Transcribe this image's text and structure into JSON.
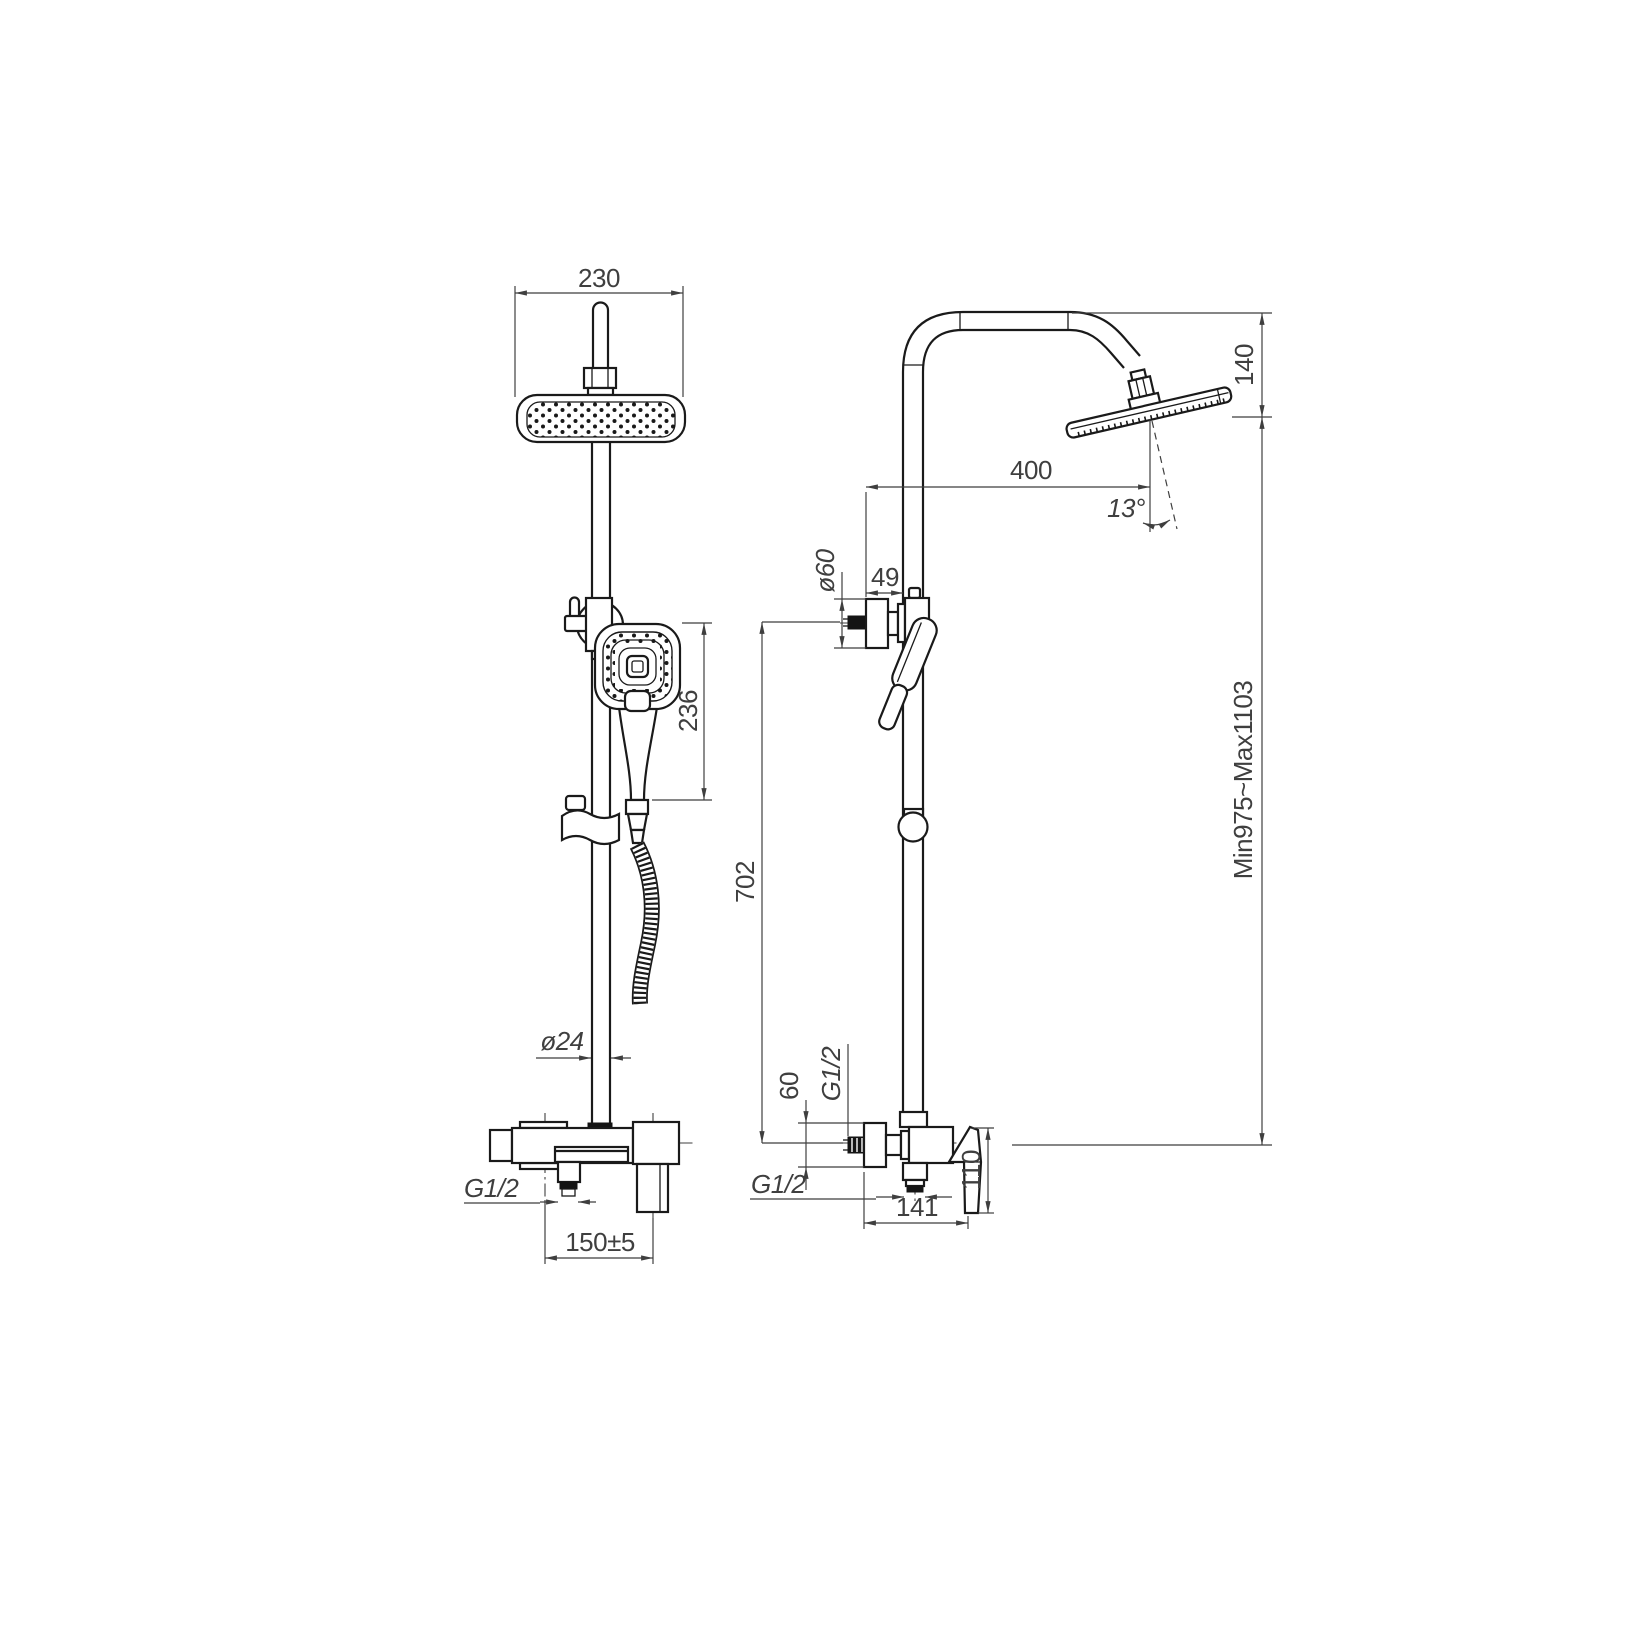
{
  "drawing": {
    "title": "shower-column-technical-drawing",
    "colors": {
      "background": "#ffffff",
      "line": "#1a1a1a",
      "dim": "#3f3f3f"
    },
    "front_view": {
      "head_width": "230",
      "hand_shower_height": "236",
      "pipe_diameter": "ø24",
      "outlet_thread": "G1/2",
      "inlet_spacing": "150±5"
    },
    "side_view": {
      "head_drop": "140",
      "head_reach": "400",
      "head_angle": "13°",
      "holder_diameter": "ø60",
      "holder_offset": "49",
      "bar_to_mixer": "702",
      "height_range": "Min975~Max1103",
      "flange_height": "60",
      "wall_thread": "G1/2",
      "outlet_thread": "G1/2",
      "handle_height": "110",
      "body_depth": "141"
    }
  }
}
